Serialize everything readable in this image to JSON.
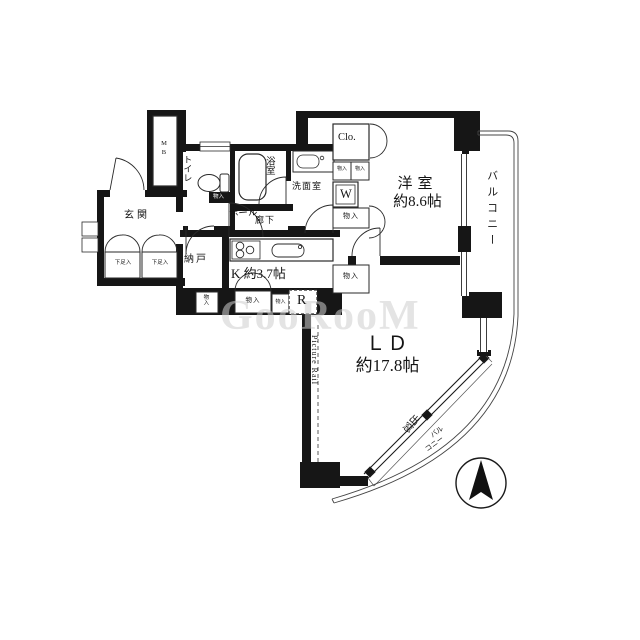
{
  "meta": {
    "bg_color": "#ffffff",
    "wall_color": "#161616",
    "line_color": "#2a2a2a",
    "watermark_color": "#cfcfcf"
  },
  "floor_plan": {
    "rooms": {
      "entrance": {
        "label": "玄関"
      },
      "hall": {
        "label": "ホール"
      },
      "corridor": {
        "label": "廊下"
      },
      "toilet": {
        "label": "トイレ"
      },
      "bath": {
        "label": "浴室"
      },
      "washroom": {
        "label": "洗面室"
      },
      "storage_room": {
        "label": "納戸"
      },
      "kitchen": {
        "label": "K 約3.7帖"
      },
      "western_room": {
        "label_line1": "洋室",
        "label_line2": "約8.6帖"
      },
      "living_dining": {
        "label_line1": "ＬＤ",
        "label_line2": "約17.8帖"
      },
      "balcony_side": {
        "label": "バルコニー"
      },
      "balcony_curve": {
        "label_line1": "バル",
        "label_line2": "コニー"
      }
    },
    "closets": {
      "clo": "Clo.",
      "storage_upper": "物入",
      "storage_lower": "物入",
      "tiny_a": "物入",
      "tiny_b": "物入",
      "kitchen_closet": "物入",
      "kitchen_closet_small": "物入",
      "nando_closet": "物入",
      "toilet_shelf": "物入",
      "shoe_a": "下足入",
      "shoe_b": "下足入"
    },
    "fixtures": {
      "meter_box": "MB",
      "washer": "W",
      "fridge": "R"
    },
    "annotations": {
      "picture_rail": "Picture Rail",
      "bay_window": "出窓"
    },
    "watermark": "GooRooM"
  }
}
